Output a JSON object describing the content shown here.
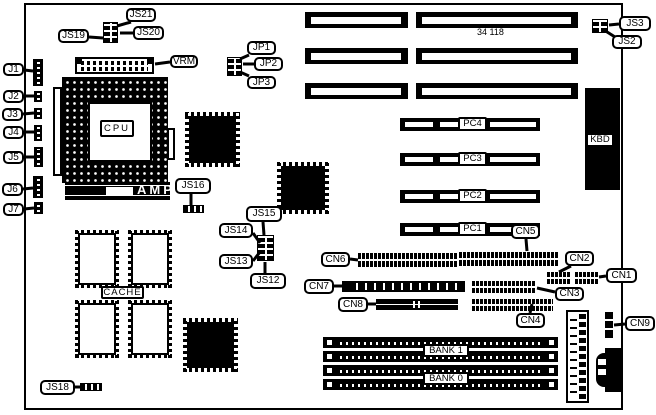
{
  "board": {
    "number": "34 118"
  },
  "callouts": [
    {
      "id": "js21",
      "text": "JS21",
      "x": 126,
      "y": 8,
      "w": 30,
      "h": 14,
      "arrow": [
        131,
        22,
        117,
        26
      ]
    },
    {
      "id": "js20",
      "text": "JS20",
      "x": 133,
      "y": 26,
      "w": 31,
      "h": 14,
      "arrow": [
        133,
        33,
        120,
        33
      ]
    },
    {
      "id": "js19",
      "text": "JS19",
      "x": 58,
      "y": 29,
      "w": 31,
      "h": 14,
      "arrow": [
        89,
        37,
        103,
        38
      ]
    },
    {
      "id": "vrm",
      "text": "VRM",
      "x": 170,
      "y": 55,
      "w": 28,
      "h": 13,
      "arrow": [
        170,
        62,
        155,
        64
      ]
    },
    {
      "id": "j1",
      "text": "J1",
      "x": 3,
      "y": 63,
      "w": 21,
      "h": 13,
      "arrow": [
        24,
        70,
        33,
        71
      ]
    },
    {
      "id": "j2",
      "text": "J2",
      "x": 3,
      "y": 90,
      "w": 21,
      "h": 13,
      "arrow": [
        24,
        96,
        34,
        96
      ]
    },
    {
      "id": "j3",
      "text": "J3",
      "x": 2,
      "y": 108,
      "w": 21,
      "h": 13,
      "arrow": [
        23,
        114,
        34,
        113
      ]
    },
    {
      "id": "j4",
      "text": "J4",
      "x": 3,
      "y": 126,
      "w": 21,
      "h": 13,
      "arrow": [
        24,
        132,
        34,
        132
      ]
    },
    {
      "id": "j5",
      "text": "J5",
      "x": 3,
      "y": 151,
      "w": 21,
      "h": 13,
      "arrow": [
        24,
        157,
        34,
        157
      ]
    },
    {
      "id": "j6",
      "text": "J6",
      "x": 2,
      "y": 183,
      "w": 21,
      "h": 13,
      "arrow": [
        23,
        189,
        33,
        188
      ]
    },
    {
      "id": "j7",
      "text": "J7",
      "x": 3,
      "y": 203,
      "w": 21,
      "h": 13,
      "arrow": [
        24,
        209,
        34,
        208
      ]
    },
    {
      "id": "cpu",
      "text": "CPU",
      "x": 100,
      "y": 120,
      "w": 34,
      "h": 17,
      "variant": "sq"
    },
    {
      "id": "amp",
      "text": "AMP",
      "x": 136,
      "y": 183,
      "variant": "inv"
    },
    {
      "id": "js16",
      "text": "JS16",
      "x": 175,
      "y": 178,
      "w": 36,
      "h": 16,
      "arrow": [
        191,
        194,
        191,
        205
      ]
    },
    {
      "id": "cache",
      "text": "CACHE",
      "x": 101,
      "y": 286,
      "w": 43,
      "h": 13,
      "variant": "sq"
    },
    {
      "id": "js18",
      "text": "JS18",
      "x": 40,
      "y": 380,
      "w": 35,
      "h": 15,
      "arrow": [
        75,
        387,
        81,
        387
      ]
    },
    {
      "id": "js15",
      "text": "JS15",
      "x": 246,
      "y": 206,
      "w": 36,
      "h": 16,
      "arrow": [
        263,
        222,
        264,
        235
      ]
    },
    {
      "id": "js14",
      "text": "JS14",
      "x": 219,
      "y": 223,
      "w": 34,
      "h": 15,
      "arrow": [
        253,
        233,
        260,
        243
      ]
    },
    {
      "id": "js13",
      "text": "JS13",
      "x": 219,
      "y": 254,
      "w": 34,
      "h": 15,
      "arrow": [
        253,
        261,
        260,
        252
      ]
    },
    {
      "id": "js12",
      "text": "JS12",
      "x": 250,
      "y": 273,
      "w": 36,
      "h": 16,
      "arrow": [
        265,
        273,
        265,
        262
      ]
    },
    {
      "id": "jp1",
      "text": "JP1",
      "x": 247,
      "y": 41,
      "w": 29,
      "h": 14,
      "arrow": [
        249,
        55,
        240,
        59
      ]
    },
    {
      "id": "jp2",
      "text": "JP2",
      "x": 254,
      "y": 57,
      "w": 29,
      "h": 14,
      "arrow": [
        254,
        64,
        243,
        64
      ]
    },
    {
      "id": "jp3",
      "text": "JP3",
      "x": 247,
      "y": 76,
      "w": 29,
      "h": 13,
      "arrow": [
        249,
        76,
        240,
        72
      ]
    },
    {
      "id": "board-number",
      "text": "34 118",
      "x": 476,
      "y": 28,
      "variant": "plain"
    },
    {
      "id": "js3",
      "text": "JS3",
      "x": 619,
      "y": 16,
      "w": 32,
      "h": 15,
      "arrow": [
        619,
        24,
        609,
        25
      ]
    },
    {
      "id": "js2",
      "text": "JS2",
      "x": 612,
      "y": 35,
      "w": 30,
      "h": 14,
      "arrow": [
        615,
        37,
        604,
        30
      ]
    },
    {
      "id": "pc4",
      "text": "PC4",
      "x": 458,
      "y": 117,
      "w": 29,
      "h": 14,
      "variant": "sq"
    },
    {
      "id": "pc3",
      "text": "PC3",
      "x": 458,
      "y": 152,
      "w": 29,
      "h": 14,
      "variant": "sq"
    },
    {
      "id": "pc2",
      "text": "PC2",
      "x": 458,
      "y": 189,
      "w": 29,
      "h": 14,
      "variant": "sq"
    },
    {
      "id": "pc1",
      "text": "PC1",
      "x": 458,
      "y": 222,
      "w": 29,
      "h": 14,
      "variant": "sq"
    },
    {
      "id": "kbd",
      "text": "KBD",
      "x": 586,
      "y": 133,
      "w": 28,
      "h": 14,
      "variant": "sq"
    },
    {
      "id": "cn5",
      "text": "CN5",
      "x": 511,
      "y": 224,
      "w": 29,
      "h": 15,
      "arrow": [
        526,
        239,
        527,
        251
      ]
    },
    {
      "id": "cn6",
      "text": "CN6",
      "x": 321,
      "y": 252,
      "w": 29,
      "h": 15,
      "arrow": [
        350,
        259,
        358,
        260
      ]
    },
    {
      "id": "cn7",
      "text": "CN7",
      "x": 304,
      "y": 279,
      "w": 30,
      "h": 15,
      "arrow": [
        334,
        286,
        342,
        286
      ]
    },
    {
      "id": "cn8",
      "text": "CN8",
      "x": 338,
      "y": 297,
      "w": 30,
      "h": 15,
      "arrow": [
        368,
        304,
        376,
        304
      ]
    },
    {
      "id": "cn2",
      "text": "CN2",
      "x": 565,
      "y": 251,
      "w": 29,
      "h": 15,
      "arrow": [
        571,
        266,
        559,
        272
      ]
    },
    {
      "id": "cn1",
      "text": "CN1",
      "x": 606,
      "y": 268,
      "w": 31,
      "h": 15,
      "arrow": [
        606,
        276,
        599,
        277
      ]
    },
    {
      "id": "cn3",
      "text": "CN3",
      "x": 555,
      "y": 287,
      "w": 29,
      "h": 14,
      "arrow": [
        555,
        292,
        537,
        288
      ]
    },
    {
      "id": "cn4",
      "text": "CN4",
      "x": 516,
      "y": 313,
      "w": 29,
      "h": 15,
      "arrow": [
        530,
        313,
        532,
        304
      ]
    },
    {
      "id": "cn9",
      "text": "CN9",
      "x": 625,
      "y": 316,
      "w": 30,
      "h": 15,
      "arrow": [
        625,
        324,
        614,
        325
      ]
    },
    {
      "id": "bank1",
      "text": "BANK 1",
      "x": 423,
      "y": 344,
      "w": 46,
      "h": 13,
      "variant": "sq"
    },
    {
      "id": "bank0",
      "text": "BANK 0",
      "x": 423,
      "y": 372,
      "w": 46,
      "h": 13,
      "variant": "sq"
    }
  ]
}
